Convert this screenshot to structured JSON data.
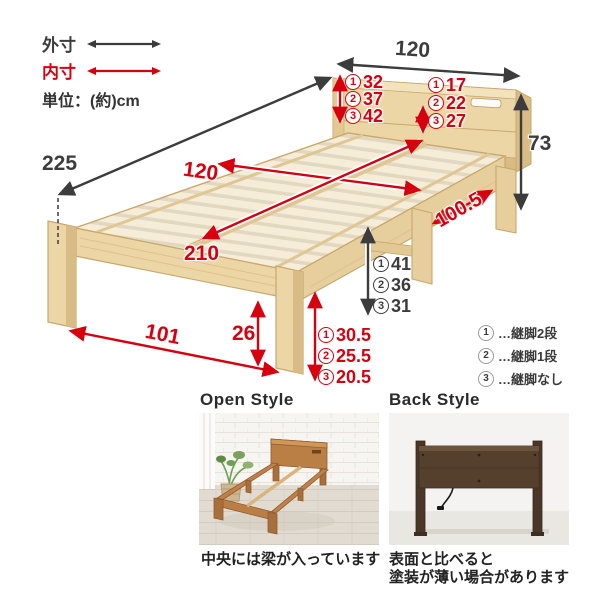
{
  "legend": {
    "outer_label": "外寸",
    "inner_label": "内寸",
    "unit_label": "単位：(約)cm"
  },
  "dims": {
    "top_width": "120",
    "outer_length": "225",
    "total_height": "73",
    "inner_width": "120",
    "inner_length": "210",
    "front_leg_span": "101",
    "under_frame_height": "26",
    "side_leg_span": "100.5"
  },
  "option_dims": {
    "headboard_above_slats": [
      {
        "n": "1",
        "v": "32"
      },
      {
        "n": "2",
        "v": "37"
      },
      {
        "n": "3",
        "v": "42"
      }
    ],
    "shelf_above_slats": [
      {
        "n": "1",
        "v": "17"
      },
      {
        "n": "2",
        "v": "22"
      },
      {
        "n": "3",
        "v": "27"
      }
    ],
    "under_bed_clearance": [
      {
        "n": "1",
        "v": "41"
      },
      {
        "n": "2",
        "v": "36"
      },
      {
        "n": "3",
        "v": "31"
      }
    ],
    "frame_height": [
      {
        "n": "1",
        "v": "30.5"
      },
      {
        "n": "2",
        "v": "25.5"
      },
      {
        "n": "3",
        "v": "20.5"
      }
    ]
  },
  "leg_legend": [
    {
      "n": "1",
      "label": "…継脚2段"
    },
    {
      "n": "2",
      "label": "…継脚1段"
    },
    {
      "n": "3",
      "label": "…継脚なし"
    }
  ],
  "photos": {
    "open": {
      "title": "Open Style",
      "caption": "中央には梁が入っています"
    },
    "back": {
      "title": "Back Style",
      "caption_line1": "表面と比べると",
      "caption_line2": "塗装が薄い場合があります"
    }
  },
  "colors": {
    "accent_red": "#d7000f",
    "arrow_black": "#3c3c3c",
    "wood_slat": "#f5edd8",
    "wood_face": "#ecd6a6",
    "wood_side": "#d9bc85",
    "photo_oak": "#c08049",
    "photo_walnut": "#55402d"
  }
}
